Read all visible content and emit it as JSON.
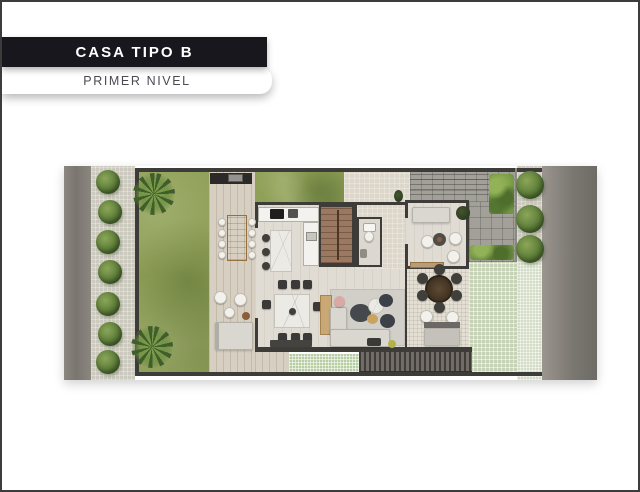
{
  "header": {
    "title": "CASA TIPO B",
    "subtitle": "PRIMER NIVEL"
  },
  "colors": {
    "banner_bg": "#17171d",
    "banner_text": "#ffffff",
    "subtitle_text": "#4b4b52",
    "paper": "#ffffff",
    "road": "#827e79",
    "sidewalk": "#cccabf",
    "lawn": "#8fa057",
    "deck_wood": "#d7cfc1",
    "interior_floor": "#e0dcd4",
    "patio_tile": "#e3dfd4",
    "driveway": "#a3a09a",
    "green_paver": "#c6d2b6",
    "green_tile": "#b7cda2",
    "wall": "#3e3c38",
    "stair_wood": "#9a7960",
    "tree_green": "#5c7c38",
    "hedge_green": "#729544",
    "table_wood": "#c29a6a",
    "louver": "#55524d"
  },
  "plan_inventory": [
    "street-left",
    "sidewalk-trees",
    "front-lawn",
    "wood-deck-terrace",
    "bbq-grill",
    "outdoor-wood-dining-table",
    "lounge-chairs",
    "deck-sofa",
    "kitchen-counter",
    "kitchen-island",
    "staircase",
    "powder-room",
    "entry-hall",
    "dining-table-8-chairs",
    "living-rug-sectional",
    "tv-room",
    "round-patio-table",
    "outdoor-sofa",
    "driveway-grid",
    "hedges",
    "green-pavers",
    "street-right"
  ]
}
